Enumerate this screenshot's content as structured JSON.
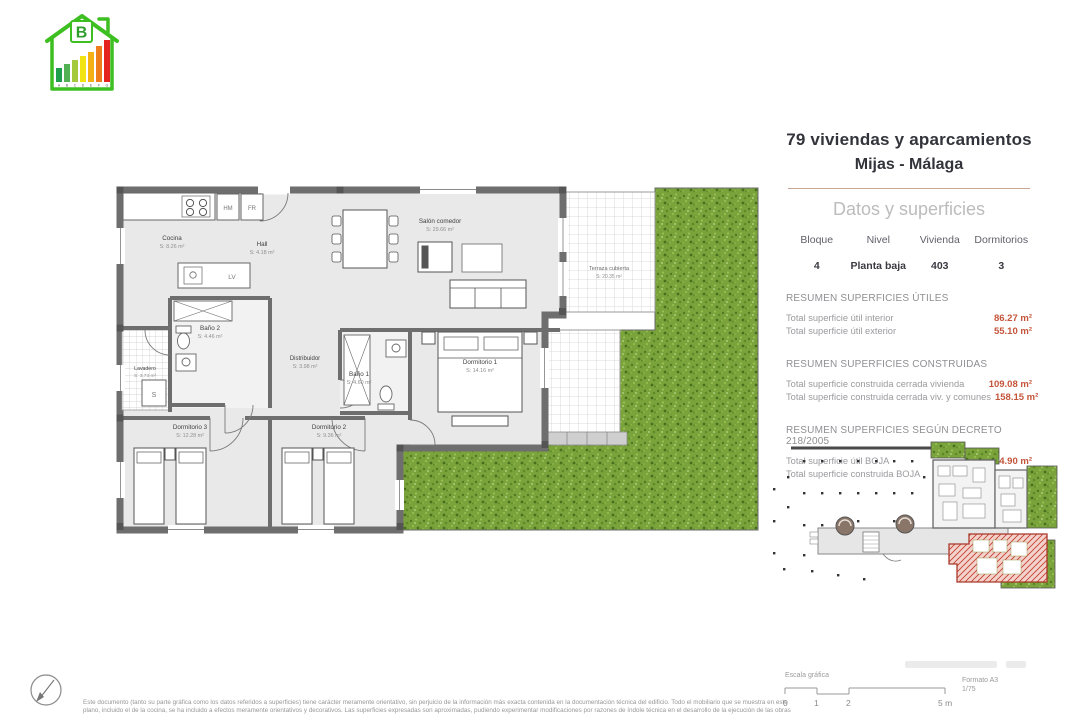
{
  "header": {
    "title_line1": "79 viviendas y aparcamientos",
    "title_line2": "Mijas - Málaga",
    "subtitle": "Datos y superficies"
  },
  "info_table": {
    "columns": [
      "Bloque",
      "Nivel",
      "Vivienda",
      "Dormitorios"
    ],
    "values": [
      "4",
      "Planta baja",
      "403",
      "3"
    ]
  },
  "sections": [
    {
      "title": "RESUMEN SUPERFICIES ÚTILES",
      "rows": [
        {
          "label": "Total superficie útil interior",
          "value": "86.27 m²"
        },
        {
          "label": "Total superficie útil exterior",
          "value": "55.10 m²"
        }
      ]
    },
    {
      "title": "RESUMEN SUPERFICIES CONSTRUIDAS",
      "rows": [
        {
          "label": "Total superficie construida cerrada vivienda",
          "value": "109.08 m²"
        },
        {
          "label": "Total superficie construida cerrada viv. y comunes",
          "value": "158.15 m²"
        }
      ]
    },
    {
      "title": "RESUMEN SUPERFICIES SEGÚN DECRETO 218/2005",
      "rows": [
        {
          "label": "Total superficie útil BOJA",
          "value": "94.90 m²"
        },
        {
          "label": "Total superficie construida BOJA",
          "value": "143.94 m²"
        }
      ]
    }
  ],
  "plan": {
    "rooms": [
      {
        "name": "Cocina",
        "area": "S: 8.26 m²"
      },
      {
        "name": "Hall",
        "area": "S: 4.18 m²"
      },
      {
        "name": "Salón comedor",
        "area": "S: 29.66 m²"
      },
      {
        "name": "Terraza cubierta",
        "area": "S: 20.35 m²"
      },
      {
        "name": "Lavadero",
        "area": "S: 3.73 m²"
      },
      {
        "name": "Baño 2",
        "area": "S: 4.46 m²"
      },
      {
        "name": "Distribuidor",
        "area": "S: 3.98 m²"
      },
      {
        "name": "Baño 1",
        "area": "S: 4.60 m²"
      },
      {
        "name": "Dormitorio 1",
        "area": "S: 14.16 m²"
      },
      {
        "name": "Dormitorio 2",
        "area": "S: 9.36 m²"
      },
      {
        "name": "Dormitorio 3",
        "area": "S: 12.28 m²"
      }
    ],
    "appliances": {
      "hm": "HM",
      "fr": "FR",
      "lv": "LV",
      "s": "S"
    }
  },
  "energy_badge": {
    "letter": "B",
    "scale_letters": [
      "A",
      "B",
      "C",
      "D",
      "E",
      "F",
      "G"
    ],
    "bar_colors": [
      "#1f9e4b",
      "#52b153",
      "#a5c93c",
      "#f2e313",
      "#f5b015",
      "#ef7c1a",
      "#e52420"
    ]
  },
  "footer": {
    "scale_label": "Escala gráfica",
    "scale_ticks": [
      "0",
      "1",
      "2",
      "5 m"
    ],
    "format_line1": "Formato A3",
    "format_line2": "1/75",
    "disclaimer_line1": "Este documento (tanto su parte gráfica como los datos referidos a superficies) tiene carácter meramente orientativo, sin perjuicio de la información más exacta contenida en la documentación técnica del edificio. Todo el mobiliario que se muestra en este",
    "disclaimer_line2": "plano, incluido el de la cocina, se ha incluido a efectos meramente orientativos y decorativos. Las superficies expresadas son aproximadas, pudiendo experimentar modificaciones por razones de índole técnica en el desarrollo de la ejecución de las obras"
  },
  "colors": {
    "accent_value": "#c4543a",
    "garden_green": "#7aa33c",
    "wall_gray": "#6e6e6e",
    "logo_green": "#3dbf21",
    "highlight_red": "#b03a2e"
  }
}
